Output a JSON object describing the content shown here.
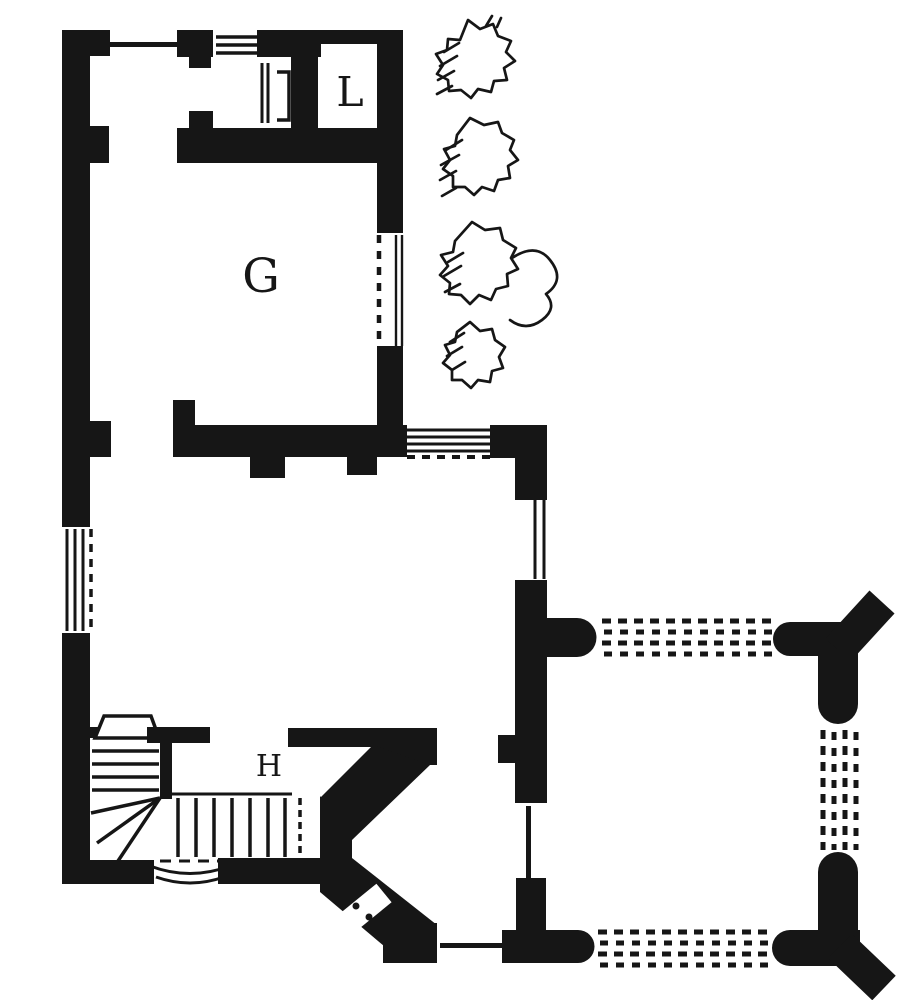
{
  "page": {
    "kind": "floor-plan-engraving",
    "colors": {
      "ink": "#161616",
      "paper": "#ffffff"
    }
  },
  "plan": {
    "rooms": {
      "G": {
        "label": "G"
      },
      "L": {
        "label": "L"
      },
      "H": {
        "label": "H"
      }
    }
  }
}
